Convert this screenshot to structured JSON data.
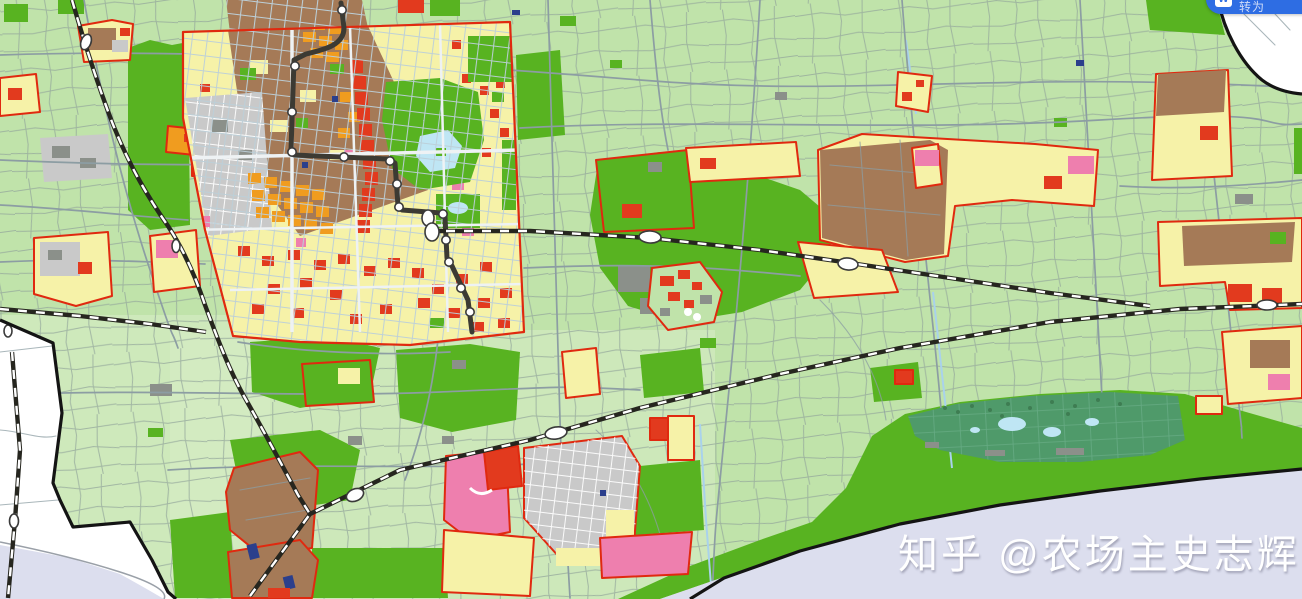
{
  "watermark": {
    "text": "知乎 @农场主史志辉"
  },
  "floating_button": {
    "icon": "W",
    "label": "转为"
  },
  "colors": {
    "field": "#c0e3aa",
    "field_light": "#d7edc6",
    "farm_line": "#92a59a",
    "road": "#8c9da3",
    "green": "#58b321",
    "wetland": "#4f9a6a",
    "residential_yellow": "#f6f2a8",
    "industrial_brown": "#a57a57",
    "commercial_red": "#e23a1e",
    "orange": "#f09c1f",
    "pink": "#ee7fae",
    "gray_zone": "#c9c9c9",
    "village_gray": "#8b908a",
    "water": "#dcdeee",
    "pond": "#bfe6f4",
    "canal": "#a9d2ec",
    "boundary": "#141414",
    "zone_outline": "#e0290f",
    "railway_dark": "#26261f",
    "metro_dark": "#3c3a33",
    "navy": "#2b3f8c",
    "white_road": "#eef2f4",
    "button_blue": "#2e6de3"
  }
}
